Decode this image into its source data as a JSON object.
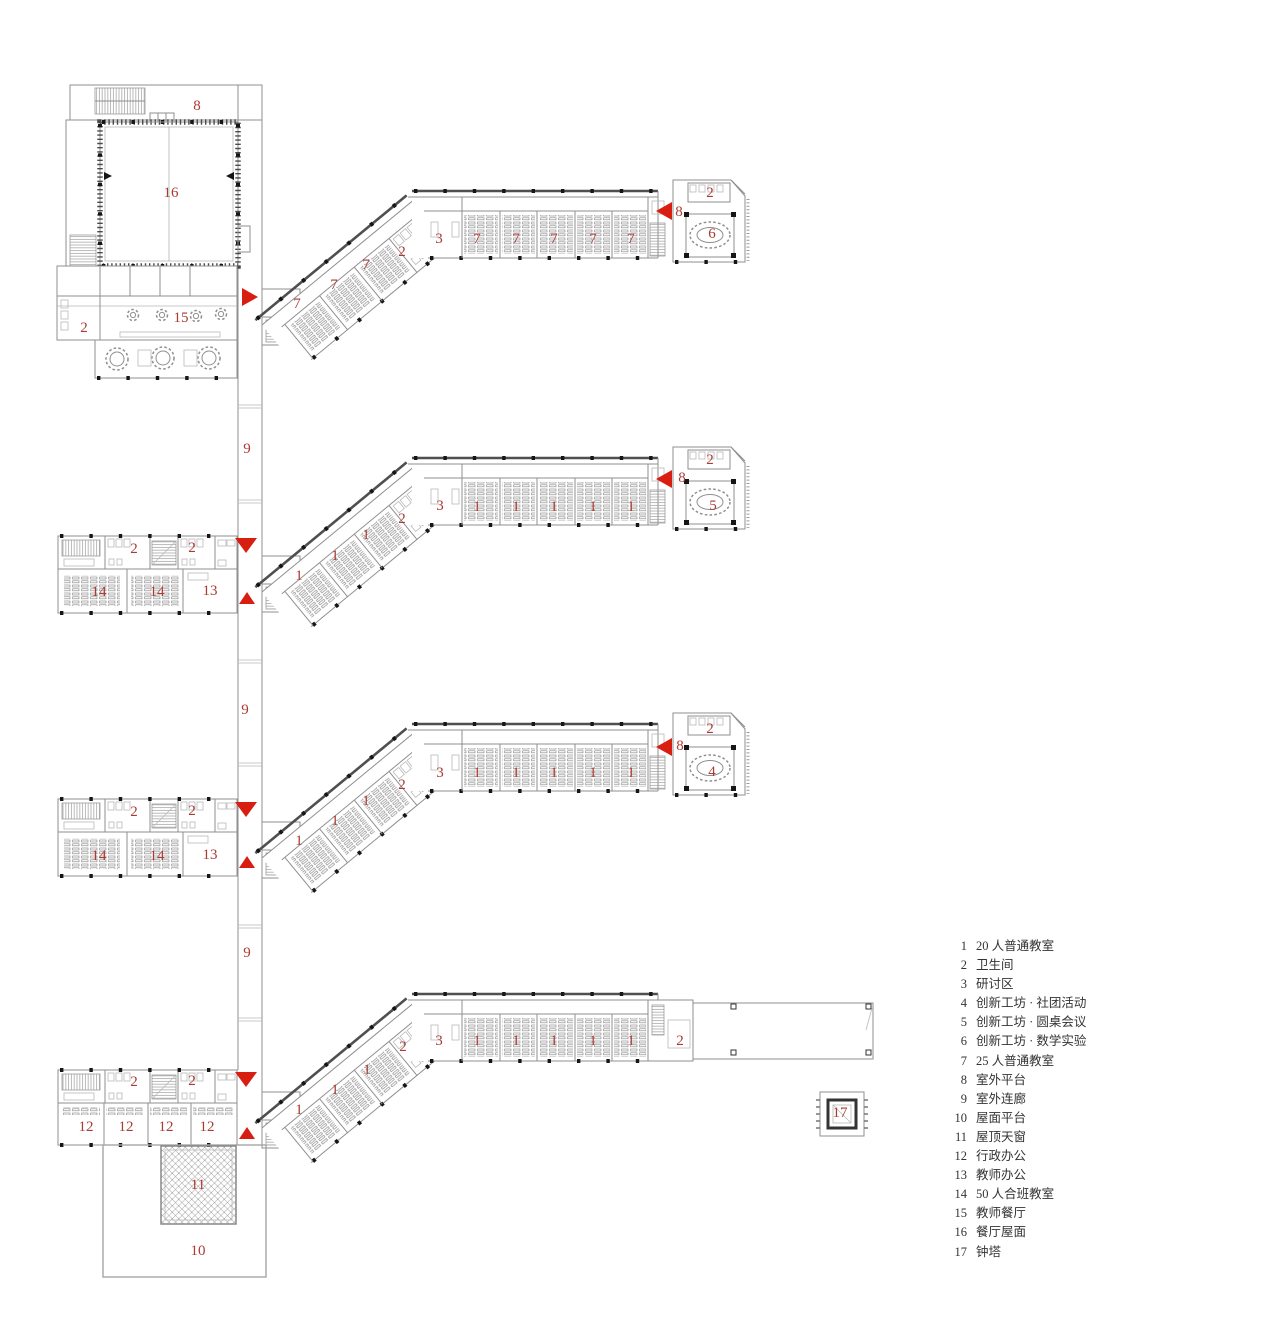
{
  "page": {
    "background": "#ffffff"
  },
  "colors": {
    "label_red": "#a93b32",
    "marker_red": "#d81e10",
    "wall": "#8f8f8f",
    "wall_dark": "#4f4f4f",
    "column": "#161616"
  },
  "legend": {
    "items": [
      {
        "num": "1",
        "label": "20 人普通教室"
      },
      {
        "num": "2",
        "label": "卫生间"
      },
      {
        "num": "3",
        "label": "研讨区"
      },
      {
        "num": "4",
        "label": "创新工坊 · 社团活动"
      },
      {
        "num": "5",
        "label": "创新工坊 · 圆桌会议"
      },
      {
        "num": "6",
        "label": "创新工坊 · 数学实验"
      },
      {
        "num": "7",
        "label": "25 人普通教室"
      },
      {
        "num": "8",
        "label": "室外平台"
      },
      {
        "num": "9",
        "label": "室外连廊"
      },
      {
        "num": "10",
        "label": "屋面平台"
      },
      {
        "num": "11",
        "label": "屋顶天窗"
      },
      {
        "num": "12",
        "label": "行政办公"
      },
      {
        "num": "13",
        "label": "教师办公"
      },
      {
        "num": "14",
        "label": "50 人合班教室"
      },
      {
        "num": "15",
        "label": "教师餐厅"
      },
      {
        "num": "16",
        "label": "餐厅屋面"
      },
      {
        "num": "17",
        "label": "钟塔"
      }
    ]
  },
  "plans": [
    {
      "name": "floor-plan-1-top",
      "labels": [
        {
          "t": "8",
          "x": 197,
          "y": 106
        },
        {
          "t": "16",
          "x": 171,
          "y": 193
        },
        {
          "t": "2",
          "x": 84,
          "y": 328
        },
        {
          "t": "15",
          "x": 181,
          "y": 318
        },
        {
          "t": "7",
          "x": 297,
          "y": 304
        },
        {
          "t": "7",
          "x": 334,
          "y": 285
        },
        {
          "t": "7",
          "x": 366,
          "y": 265
        },
        {
          "t": "2",
          "x": 402,
          "y": 252
        },
        {
          "t": "3",
          "x": 439,
          "y": 239
        },
        {
          "t": "7",
          "x": 477,
          "y": 239
        },
        {
          "t": "7",
          "x": 516,
          "y": 239
        },
        {
          "t": "7",
          "x": 554,
          "y": 239
        },
        {
          "t": "7",
          "x": 593,
          "y": 239
        },
        {
          "t": "7",
          "x": 631,
          "y": 239
        },
        {
          "t": "8",
          "x": 679,
          "y": 212
        },
        {
          "t": "2",
          "x": 710,
          "y": 193
        },
        {
          "t": "6",
          "x": 712,
          "y": 234
        }
      ],
      "markers": [
        {
          "dir": "right",
          "x": 250,
          "y": 297
        },
        {
          "dir": "left",
          "x": 664,
          "y": 211
        }
      ]
    },
    {
      "name": "floor-plan-2",
      "labels": [
        {
          "t": "9",
          "x": 247,
          "y": 449
        },
        {
          "t": "2",
          "x": 134,
          "y": 549
        },
        {
          "t": "2",
          "x": 192,
          "y": 548
        },
        {
          "t": "14",
          "x": 99,
          "y": 592
        },
        {
          "t": "14",
          "x": 157,
          "y": 592
        },
        {
          "t": "13",
          "x": 210,
          "y": 591
        },
        {
          "t": "1",
          "x": 299,
          "y": 576
        },
        {
          "t": "1",
          "x": 335,
          "y": 556
        },
        {
          "t": "1",
          "x": 366,
          "y": 535
        },
        {
          "t": "2",
          "x": 402,
          "y": 519
        },
        {
          "t": "3",
          "x": 440,
          "y": 506
        },
        {
          "t": "1",
          "x": 477,
          "y": 507
        },
        {
          "t": "1",
          "x": 516,
          "y": 507
        },
        {
          "t": "1",
          "x": 554,
          "y": 507
        },
        {
          "t": "1",
          "x": 593,
          "y": 507
        },
        {
          "t": "1",
          "x": 631,
          "y": 507
        },
        {
          "t": "8",
          "x": 682,
          "y": 478
        },
        {
          "t": "2",
          "x": 710,
          "y": 460
        },
        {
          "t": "5",
          "x": 713,
          "y": 506
        }
      ],
      "markers": [
        {
          "dir": "down",
          "x": 246,
          "y": 545
        },
        {
          "dir": "up",
          "x": 247,
          "y": 598
        },
        {
          "dir": "left",
          "x": 664,
          "y": 479
        }
      ]
    },
    {
      "name": "floor-plan-3",
      "labels": [
        {
          "t": "9",
          "x": 245,
          "y": 710
        },
        {
          "t": "2",
          "x": 134,
          "y": 812
        },
        {
          "t": "2",
          "x": 192,
          "y": 811
        },
        {
          "t": "14",
          "x": 99,
          "y": 856
        },
        {
          "t": "14",
          "x": 157,
          "y": 856
        },
        {
          "t": "13",
          "x": 210,
          "y": 855
        },
        {
          "t": "1",
          "x": 299,
          "y": 841
        },
        {
          "t": "1",
          "x": 335,
          "y": 821
        },
        {
          "t": "1",
          "x": 366,
          "y": 801
        },
        {
          "t": "2",
          "x": 402,
          "y": 785
        },
        {
          "t": "3",
          "x": 440,
          "y": 773
        },
        {
          "t": "1",
          "x": 477,
          "y": 773
        },
        {
          "t": "1",
          "x": 516,
          "y": 773
        },
        {
          "t": "1",
          "x": 554,
          "y": 773
        },
        {
          "t": "1",
          "x": 593,
          "y": 773
        },
        {
          "t": "1",
          "x": 631,
          "y": 773
        },
        {
          "t": "8",
          "x": 680,
          "y": 746
        },
        {
          "t": "2",
          "x": 710,
          "y": 729
        },
        {
          "t": "4",
          "x": 712,
          "y": 772
        }
      ],
      "markers": [
        {
          "dir": "down",
          "x": 246,
          "y": 809
        },
        {
          "dir": "up",
          "x": 247,
          "y": 862
        },
        {
          "dir": "left",
          "x": 664,
          "y": 747
        }
      ]
    },
    {
      "name": "floor-plan-4-bottom",
      "labels": [
        {
          "t": "9",
          "x": 247,
          "y": 953
        },
        {
          "t": "2",
          "x": 134,
          "y": 1082
        },
        {
          "t": "2",
          "x": 192,
          "y": 1081
        },
        {
          "t": "12",
          "x": 86,
          "y": 1127
        },
        {
          "t": "12",
          "x": 126,
          "y": 1127
        },
        {
          "t": "12",
          "x": 166,
          "y": 1127
        },
        {
          "t": "12",
          "x": 207,
          "y": 1127
        },
        {
          "t": "1",
          "x": 299,
          "y": 1110
        },
        {
          "t": "1",
          "x": 335,
          "y": 1090
        },
        {
          "t": "1",
          "x": 367,
          "y": 1070
        },
        {
          "t": "2",
          "x": 403,
          "y": 1047
        },
        {
          "t": "3",
          "x": 439,
          "y": 1041
        },
        {
          "t": "1",
          "x": 477,
          "y": 1041
        },
        {
          "t": "1",
          "x": 516,
          "y": 1041
        },
        {
          "t": "1",
          "x": 554,
          "y": 1041
        },
        {
          "t": "1",
          "x": 593,
          "y": 1041
        },
        {
          "t": "1",
          "x": 631,
          "y": 1041
        },
        {
          "t": "2",
          "x": 680,
          "y": 1041
        },
        {
          "t": "11",
          "x": 198,
          "y": 1185
        },
        {
          "t": "10",
          "x": 198,
          "y": 1251
        },
        {
          "t": "17",
          "x": 840,
          "y": 1113
        }
      ],
      "markers": [
        {
          "dir": "down",
          "x": 246,
          "y": 1079
        },
        {
          "dir": "up",
          "x": 247,
          "y": 1133
        }
      ]
    }
  ]
}
